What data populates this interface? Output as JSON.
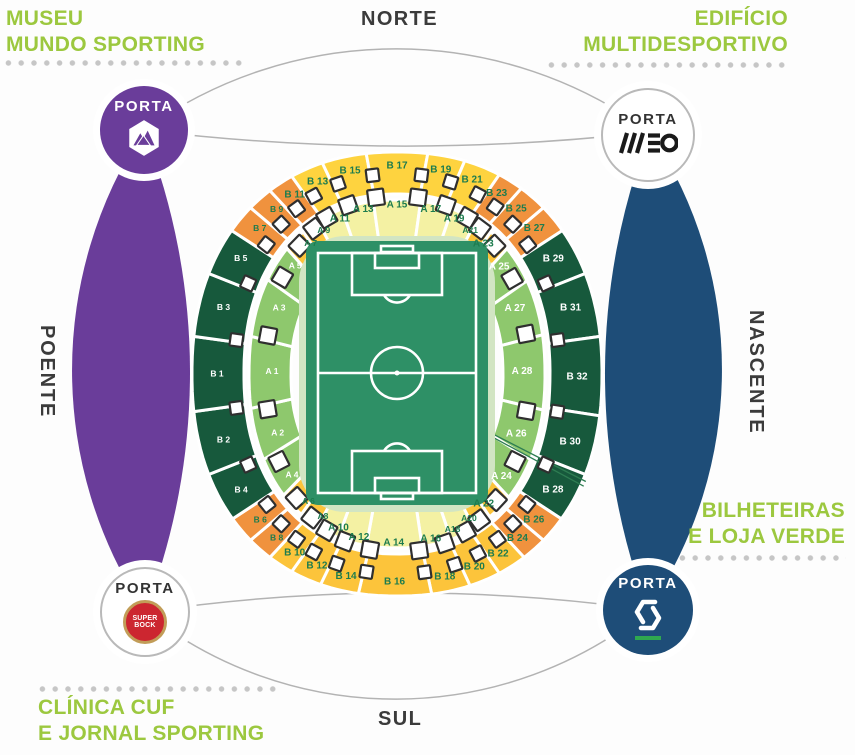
{
  "compass": {
    "north": "NORTE",
    "south": "SUL",
    "west": "POENTE",
    "east": "NASCENTE"
  },
  "corner_labels": {
    "top_left": {
      "line1": "MUSEU",
      "line2": "MUNDO SPORTING"
    },
    "top_right": {
      "line1": "EDIFÍCIO",
      "line2": "MULTIDESPORTIVO"
    },
    "right": {
      "line1": "BILHETEIRAS",
      "line2": "E LOJA VERDE"
    },
    "bottom_left": {
      "line1": "CLÍNICA CUF",
      "line2": "E JORNAL SPORTING"
    }
  },
  "portas": {
    "northwest": {
      "label": "PORTA",
      "logo": "mountain-hexagon",
      "style": "purple"
    },
    "northeast": {
      "label": "PORTA",
      "logo": "meo",
      "style": "white"
    },
    "southwest": {
      "label": "PORTA",
      "logo": "super-bock",
      "style": "white"
    },
    "southeast": {
      "label": "PORTA",
      "logo": "cgd",
      "style": "blue"
    }
  },
  "super_bock_text": {
    "line1": "SUPER",
    "line2": "BOCK"
  },
  "colors": {
    "purple": "#6a3d9a",
    "blue": "#1e4d78",
    "lime_text": "#9cc83f",
    "dark_text": "#3b3b3b",
    "yellow": "#fed33f",
    "gold": "#fcc43b",
    "orange": "#f0923e",
    "pale": "#f4f1a3",
    "lgreen": "#8ec86d",
    "dark": "#17593c",
    "pitch": "#2e9066",
    "apron": "#d2e5c3",
    "label_green": "#1d7c4e",
    "gate_border": "#2f2f2f",
    "band_stroke": "#b3b3b3",
    "dots": "#c6c6c6"
  },
  "stadium": {
    "sections": [
      {
        "l": "B 13",
        "r": "B",
        "a0": 331.5,
        "a1": 341,
        "c": "yellow"
      },
      {
        "l": "B 15",
        "r": "B",
        "a0": 341,
        "a1": 353,
        "c": "yellow"
      },
      {
        "l": "B 17",
        "r": "B",
        "a0": 353,
        "a1": 367,
        "c": "yellow"
      },
      {
        "l": "B 19",
        "r": "B",
        "a0": 7,
        "a1": 17,
        "c": "yellow"
      },
      {
        "l": "B 21",
        "r": "B",
        "a0": 17,
        "a1": 27.5,
        "c": "yellow"
      },
      {
        "l": "B 23",
        "r": "B",
        "a0": 27.5,
        "a1": 35,
        "c": "orange"
      },
      {
        "l": "B 25",
        "r": "B",
        "a0": 35,
        "a1": 43.5,
        "c": "orange"
      },
      {
        "l": "B 27",
        "r": "B",
        "a0": 43.5,
        "a1": 52,
        "c": "orange"
      },
      {
        "l": "B 29",
        "r": "B",
        "a0": 52,
        "a1": 65.5,
        "c": "dark"
      },
      {
        "l": "B 31",
        "r": "B",
        "a0": 65.5,
        "a1": 82,
        "c": "dark"
      },
      {
        "l": "B 32",
        "r": "B",
        "a0": 82,
        "a1": 99,
        "c": "dark"
      },
      {
        "l": "B 30",
        "r": "B",
        "a0": 99,
        "a1": 114.5,
        "c": "dark"
      },
      {
        "l": "B 28",
        "r": "B",
        "a0": 114.5,
        "a1": 128.5,
        "c": "dark"
      },
      {
        "l": "B 26",
        "r": "B",
        "a0": 128.5,
        "a1": 136.5,
        "c": "orange"
      },
      {
        "l": "B 24",
        "r": "B",
        "a0": 136.5,
        "a1": 144,
        "c": "orange"
      },
      {
        "l": "B 22",
        "r": "B",
        "a0": 144,
        "a1": 152.5,
        "c": "gold"
      },
      {
        "l": "B 20",
        "r": "B",
        "a0": 152.5,
        "a1": 161.5,
        "c": "gold"
      },
      {
        "l": "B 18",
        "r": "B",
        "a0": 161.5,
        "a1": 172,
        "c": "gold"
      },
      {
        "l": "B 16",
        "r": "B",
        "a0": 172,
        "a1": 189,
        "c": "gold"
      },
      {
        "l": "B 14",
        "r": "B",
        "a0": 189,
        "a1": 199.5,
        "c": "gold"
      },
      {
        "l": "B 12",
        "r": "B",
        "a0": 199.5,
        "a1": 208.5,
        "c": "gold"
      },
      {
        "l": "B 10",
        "r": "B",
        "a0": 208.5,
        "a1": 216,
        "c": "gold"
      },
      {
        "l": "B 8",
        "r": "B",
        "a0": 216,
        "a1": 223.5,
        "c": "orange"
      },
      {
        "l": "B 6",
        "r": "B",
        "a0": 223.5,
        "a1": 231.5,
        "c": "orange"
      },
      {
        "l": "B 4",
        "r": "B",
        "a0": 231.5,
        "a1": 245.5,
        "c": "dark"
      },
      {
        "l": "B 2",
        "r": "B",
        "a0": 245.5,
        "a1": 262,
        "c": "dark"
      },
      {
        "l": "B 1",
        "r": "B",
        "a0": 262,
        "a1": 278,
        "c": "dark"
      },
      {
        "l": "B 3",
        "r": "B",
        "a0": 278,
        "a1": 294.5,
        "c": "dark"
      },
      {
        "l": "B 5",
        "r": "B",
        "a0": 294.5,
        "a1": 308,
        "c": "dark"
      },
      {
        "l": "B 7",
        "r": "B",
        "a0": 308,
        "a1": 316.5,
        "c": "orange"
      },
      {
        "l": "B 9",
        "r": "B",
        "a0": 316.5,
        "a1": 324,
        "c": "orange"
      },
      {
        "l": "B 11",
        "r": "B",
        "a0": 324,
        "a1": 331.5,
        "c": "orange"
      },
      {
        "l": "A 11",
        "r": "A",
        "a0": 330,
        "a1": 340.5,
        "c": "pale"
      },
      {
        "l": "A 13",
        "r": "A",
        "a0": 340.5,
        "a1": 352.5,
        "c": "pale"
      },
      {
        "l": "A 15",
        "r": "A",
        "a0": 352.5,
        "a1": 367.5,
        "c": "pale"
      },
      {
        "l": "A 17",
        "r": "A",
        "a0": 7.5,
        "a1": 19.5,
        "c": "pale"
      },
      {
        "l": "A 19",
        "r": "A",
        "a0": 19.5,
        "a1": 30,
        "c": "pale"
      },
      {
        "l": "A21",
        "r": "A",
        "a0": 30,
        "a1": 37,
        "c": "gold"
      },
      {
        "l": "A 23",
        "r": "A",
        "a0": 37,
        "a1": 46,
        "c": "gold"
      },
      {
        "l": "A 25",
        "r": "A",
        "a0": 46,
        "a1": 60,
        "c": "lgreen"
      },
      {
        "l": "A 27",
        "r": "A",
        "a0": 60,
        "a1": 79,
        "c": "lgreen"
      },
      {
        "l": "A 28",
        "r": "A",
        "a0": 79,
        "a1": 100,
        "c": "lgreen"
      },
      {
        "l": "A 26",
        "r": "A",
        "a0": 100,
        "a1": 117,
        "c": "lgreen"
      },
      {
        "l": "A 24",
        "r": "A",
        "a0": 117,
        "a1": 133,
        "c": "lgreen"
      },
      {
        "l": "A 22",
        "r": "A",
        "a0": 133,
        "a1": 143.5,
        "c": "gold"
      },
      {
        "l": "A20",
        "r": "A",
        "a0": 143.5,
        "a1": 151,
        "c": "gold"
      },
      {
        "l": "A18",
        "r": "A",
        "a0": 151,
        "a1": 161,
        "c": "pale"
      },
      {
        "l": "A 16",
        "r": "A",
        "a0": 161,
        "a1": 172,
        "c": "pale"
      },
      {
        "l": "A 14",
        "r": "A",
        "a0": 172,
        "a1": 190,
        "c": "pale"
      },
      {
        "l": "A 12",
        "r": "A",
        "a0": 190,
        "a1": 201,
        "c": "pale"
      },
      {
        "l": "A 10",
        "r": "A",
        "a0": 201,
        "a1": 210,
        "c": "pale"
      },
      {
        "l": "A8",
        "r": "A",
        "a0": 210,
        "a1": 218,
        "c": "gold"
      },
      {
        "l": "A 6",
        "r": "A",
        "a0": 218,
        "a1": 228,
        "c": "gold"
      },
      {
        "l": "A 4",
        "r": "A",
        "a0": 228,
        "a1": 243,
        "c": "lgreen"
      },
      {
        "l": "A 2",
        "r": "A",
        "a0": 243,
        "a1": 260.5,
        "c": "lgreen"
      },
      {
        "l": "A 1",
        "r": "A",
        "a0": 260.5,
        "a1": 280.5,
        "c": "lgreen"
      },
      {
        "l": "A 3",
        "r": "A",
        "a0": 280.5,
        "a1": 300.5,
        "c": "lgreen"
      },
      {
        "l": "A 5",
        "r": "A",
        "a0": 300.5,
        "a1": 314,
        "c": "lgreen"
      },
      {
        "l": "A 7",
        "r": "A",
        "a0": 314,
        "a1": 323,
        "c": "gold"
      },
      {
        "l": "A 9",
        "r": "A",
        "a0": 323,
        "a1": 330,
        "c": "gold"
      }
    ]
  }
}
